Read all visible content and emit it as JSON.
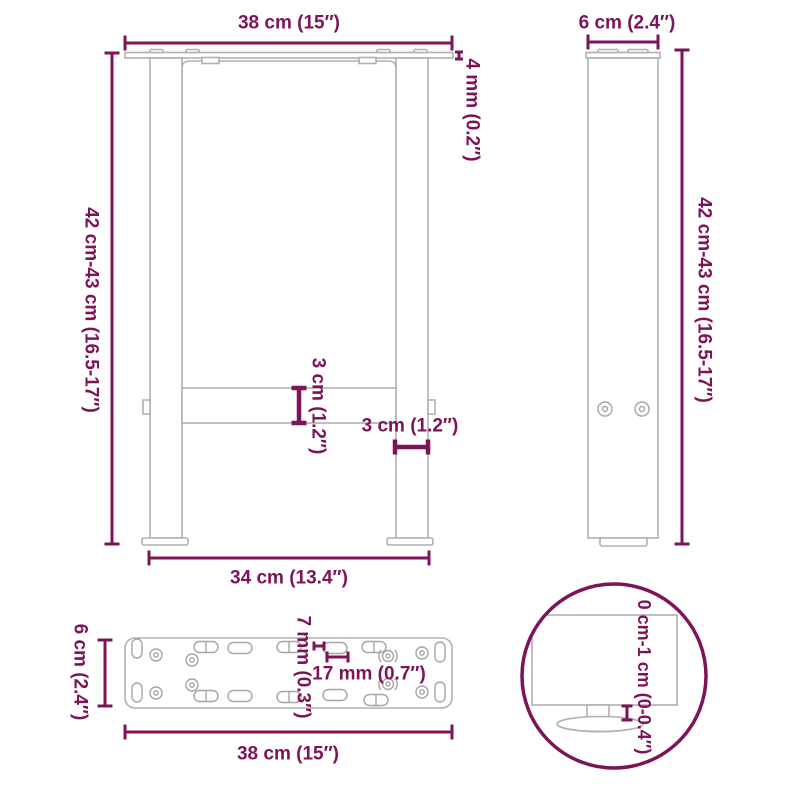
{
  "drawing_title": "table-leg-dimension-diagram",
  "colors": {
    "dimension": "#7c1457",
    "outline": "#b0b0b0",
    "hole_outline": "#a5a5a5",
    "background": "#ffffff"
  },
  "front_view": {
    "top_width": "38 cm (15″)",
    "plate_thickness": "4 mm (0.2″)",
    "height": "42 cm-43 cm (16.5-17″)",
    "crossbar": "3 cm (1.2″)",
    "leg_width": "3 cm (1.2″)",
    "bottom_width": "34 cm (13.4″)"
  },
  "side_view": {
    "depth": "6 cm (2.4″)",
    "height": "42 cm-43 cm (16.5-17″)"
  },
  "plate_view": {
    "depth": "6 cm (2.4″)",
    "slot_width": "7 mm (0.3″)",
    "slot_length": "17 mm (0.7″)",
    "width": "38 cm (15″)"
  },
  "foot_detail": {
    "adjustment": "0 cm-1 cm (0-0.4″)"
  }
}
